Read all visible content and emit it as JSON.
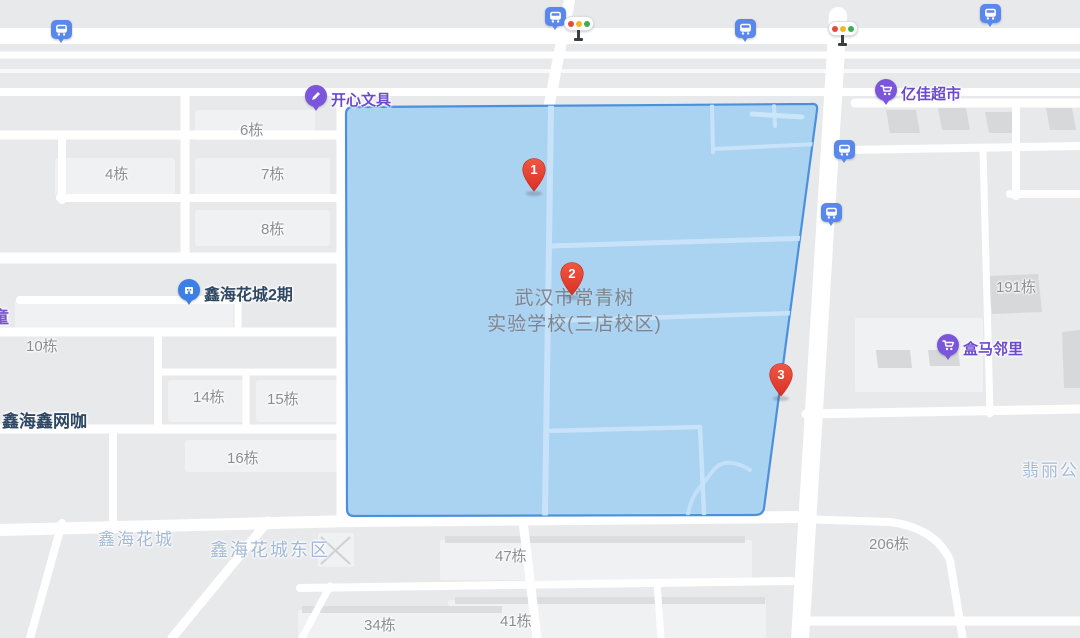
{
  "app": {
    "type": "map-view"
  },
  "polygon": {
    "fill": "#A3CFF2",
    "stroke": "#4A90DC",
    "interior_road_color": "#C8E3F9"
  },
  "markers": [
    {
      "number": "1"
    },
    {
      "number": "2"
    },
    {
      "number": "3"
    }
  ],
  "school": {
    "line1": "武汉市常青树",
    "line2": "实验学校(三店校区)"
  },
  "pois": [
    {
      "label": "开心文具",
      "icon": "stationery-pin-icon"
    },
    {
      "label": "亿佳超市",
      "icon": "supermarket-cart-pin-icon"
    },
    {
      "label": "盒马邻里",
      "icon": "supermarket-cart-pin-icon"
    },
    {
      "label": "鑫海花城2期",
      "icon": "residence-pin-icon"
    }
  ],
  "business_labels": [
    {
      "label": "鑫海鑫网咖"
    }
  ],
  "partial_labels": [
    {
      "label": "童"
    }
  ],
  "area_labels": [
    {
      "label": "鑫海花城"
    },
    {
      "label": "鑫海花城东区"
    },
    {
      "label": "翡丽公"
    }
  ],
  "building_labels": [
    "4栋",
    "6栋",
    "7栋",
    "8栋",
    "10栋",
    "14栋",
    "15栋",
    "16栋",
    "34栋",
    "41栋",
    "47栋",
    "191栋",
    "206栋"
  ],
  "icons": {
    "bus_stop": "bus-stop-icon",
    "traffic_light": "traffic-light-icon",
    "marker_pin": "red-numbered-pin-icon",
    "bus_stop_count": 6,
    "traffic_light_count": 2
  },
  "colors": {
    "map_background": "#E8E9EB",
    "road": "#FFFFFF",
    "marker_red": "#E4412D",
    "poi_purple": "#7B55DB",
    "poi_text_purple": "#6B4ACF",
    "residence_blue": "#3C7FE6",
    "bus_blue": "#5A87EC",
    "area_label_blue": "#A3B8D7",
    "building_label_gray": "#8A8E92",
    "school_text_gray": "#7E858E",
    "dark_building": "#D7D8DA"
  }
}
